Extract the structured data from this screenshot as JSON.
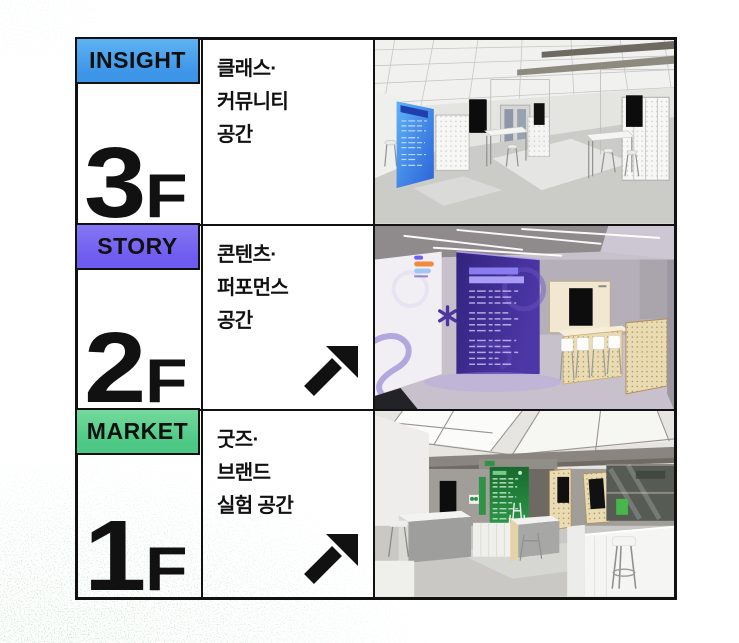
{
  "page": {
    "background": "#ffffff",
    "table_border_color": "#111111",
    "texture_color": "#bfe0cd"
  },
  "floors": [
    {
      "category_label": "INSIGHT",
      "badge_color": "#3d95e8",
      "badge_color_light": "#5fb3f2",
      "floor_number": "3",
      "floor_suffix": "F",
      "description_lines": [
        "클래스·",
        "커뮤니티",
        "공간"
      ],
      "has_link_arrow": false,
      "image_description": "white lounge interior with grid ceiling, blue wall poster, black display screens, pegboard partitions, high tables and bar stools"
    },
    {
      "category_label": "STORY",
      "badge_color": "#6e5bf0",
      "badge_color_light": "#8577f4",
      "floor_number": "2",
      "floor_suffix": "F",
      "description_lines": [
        "콘텐츠·",
        "퍼포먼스",
        "공간"
      ],
      "has_link_arrow": true,
      "image_description": "interior with concrete ceiling and light tubes, deep purple info wall with white text, wooden bar counter with white stools, black screen and wooden pegboard partition"
    },
    {
      "category_label": "MARKET",
      "badge_color": "#4cc884",
      "badge_color_light": "#74d99d",
      "floor_number": "1",
      "floor_suffix": "F",
      "description_lines": [
        "굿즈·",
        "브랜드",
        "실험 공간"
      ],
      "has_link_arrow": true,
      "image_description": "bright retail space with skylight ceiling, green info wall, white kiosks and counters, pegboard panels, black screens, bar stool and glass partition"
    }
  ],
  "icons": {
    "link_arrow": "northeast-arrow-icon",
    "background_texture": "green-grain-texture"
  }
}
